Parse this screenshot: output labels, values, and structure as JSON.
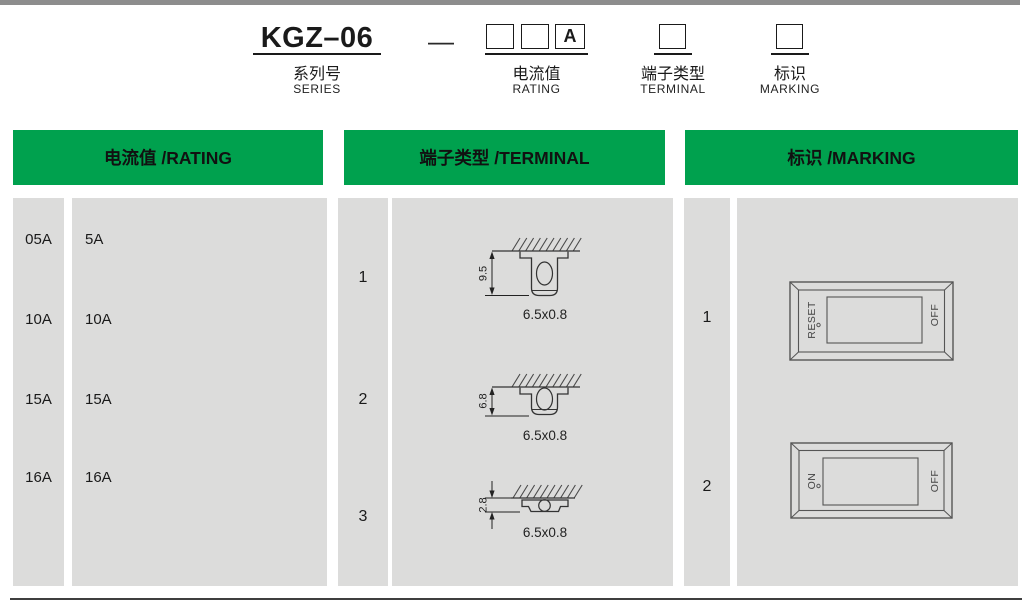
{
  "part_number": {
    "series_code": "KGZ–06",
    "separator": "—",
    "rating_box_suffix": "A",
    "labels": {
      "series_zh": "系列号",
      "series_en": "SERIES",
      "rating_zh": "电流值",
      "rating_en": "RATING",
      "terminal_zh": "端子类型",
      "terminal_en": "TERMINAL",
      "marking_zh": "标识",
      "marking_en": "MARKING"
    }
  },
  "sections": {
    "rating": {
      "header": "电流值 /RATING",
      "rows": [
        {
          "code": "05A",
          "value": "5A"
        },
        {
          "code": "10A",
          "value": "10A"
        },
        {
          "code": "15A",
          "value": "15A"
        },
        {
          "code": "16A",
          "value": "16A"
        }
      ]
    },
    "terminal": {
      "header": "端子类型 /TERMINAL",
      "rows": [
        {
          "code": "1",
          "height": "9.5",
          "size": "6.5x0.8"
        },
        {
          "code": "2",
          "height": "6.8",
          "size": "6.5x0.8"
        },
        {
          "code": "3",
          "height": "2.8",
          "size": "6.5x0.8"
        }
      ]
    },
    "marking": {
      "header": "标识 /MARKING",
      "rows": [
        {
          "code": "1",
          "left_label": "RESET",
          "right_label": "OFF"
        },
        {
          "code": "2",
          "left_label": "ON",
          "right_label": "OFF"
        }
      ]
    }
  },
  "colors": {
    "green": "#00a14e",
    "panel_gray": "#dcdcdb",
    "top_bar": "#8d8d8d"
  }
}
